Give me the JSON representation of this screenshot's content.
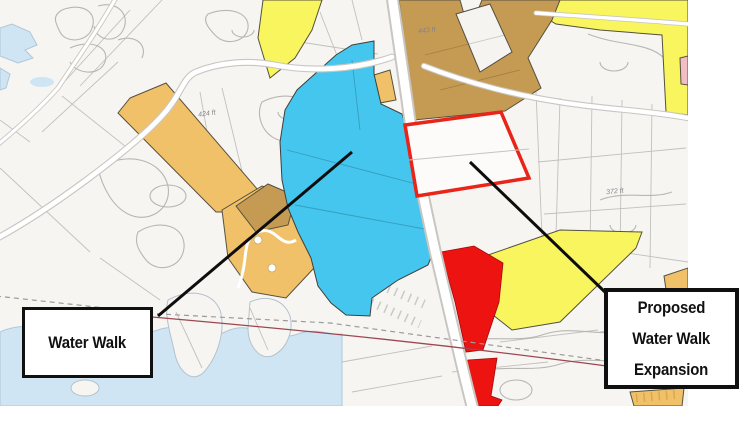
{
  "page": {
    "background": "#ffffff"
  },
  "map": {
    "colors": {
      "land": "#f7f5f2",
      "water": "#cfe5f4",
      "shore": "#aec8d8",
      "parcel_line": "#c2c0bc",
      "road_casing": "#c9c6c2",
      "road_fill": "#ffffff",
      "zone_cyan": "#45c6ee",
      "zone_yellow": "#f8f55e",
      "zone_orange": "#f1c169",
      "zone_goldenrod": "#c59b53",
      "zone_red": "#ec1310",
      "zone_pink": "#f3bdc5",
      "proposal_outline": "#e92418",
      "boundary_line": "#9c4752",
      "leader_line": "#0d0d0d",
      "callout_border": "#101010",
      "callout_bg": "#ffffff",
      "elevation_text": "#85848a"
    },
    "elevation_labels": [
      {
        "text": "424 ft"
      },
      {
        "text": "443 ft"
      },
      {
        "text": "372 ft"
      }
    ]
  },
  "callouts": {
    "water_walk": {
      "label": "Water Walk"
    },
    "proposed_expansion": {
      "line1": "Proposed",
      "line2": "Water Walk",
      "line3": "Expansion"
    }
  }
}
